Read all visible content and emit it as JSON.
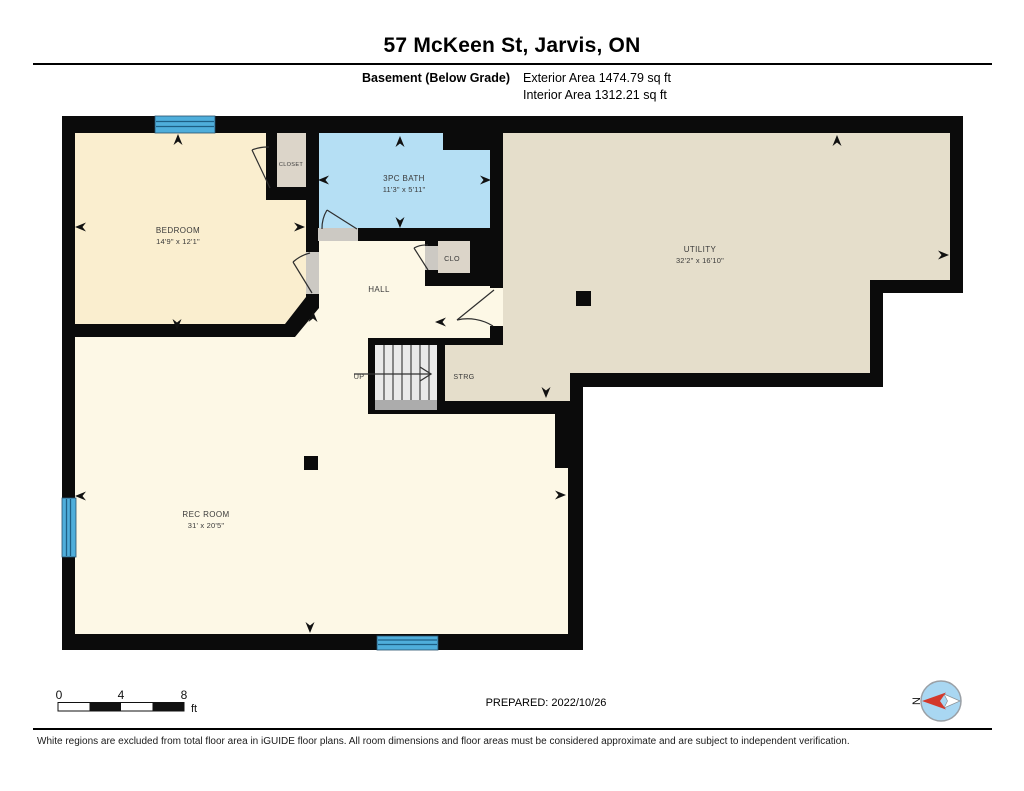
{
  "header": {
    "title": "57 McKeen St, Jarvis, ON",
    "floor_label": "Basement (Below Grade)",
    "exterior_area": "Exterior Area 1474.79 sq ft",
    "interior_area": "Interior Area 1312.21 sq ft"
  },
  "plan": {
    "rooms": {
      "bedroom": {
        "name": "BEDROOM",
        "dims": "14'9\" x 12'1\""
      },
      "closet": {
        "name": "CLOSET"
      },
      "bath": {
        "name": "3PC BATH",
        "dims": "11'3\" x 5'11\""
      },
      "clo": {
        "name": "CLO"
      },
      "hall": {
        "name": "HALL"
      },
      "utility": {
        "name": "UTILITY",
        "dims": "32'2\" x 16'10\""
      },
      "stairs": {
        "name": "UP"
      },
      "storage": {
        "name": "STRG"
      },
      "rec_room": {
        "name": "REC ROOM",
        "dims": "31' x 20'5\""
      }
    },
    "colors": {
      "wall": "#0b0b0b",
      "bedroom": "#FAEECF",
      "hall_rec": "#FDF8E6",
      "utility": "#E5DECB",
      "closet": "#DCD5C9",
      "bath": "#B5DFF4",
      "stairs": "#EAEAEA",
      "stair_landing": "#ACACAC",
      "door_jamb": "#CCC9C3",
      "window": "#4FAEDB",
      "compass_red": "#D3392B",
      "compass_blue": "#A9D7F2"
    }
  },
  "scale_bar": {
    "tick0": "0",
    "tick1": "4",
    "tick2": "8",
    "unit": "ft"
  },
  "compass": {
    "north_label": "N"
  },
  "footer": {
    "prepared": "PREPARED: 2022/10/26",
    "disclaimer": "White regions are excluded from total floor area in iGUIDE floor plans. All room dimensions and floor areas must be considered approximate and are subject to independent verification."
  }
}
